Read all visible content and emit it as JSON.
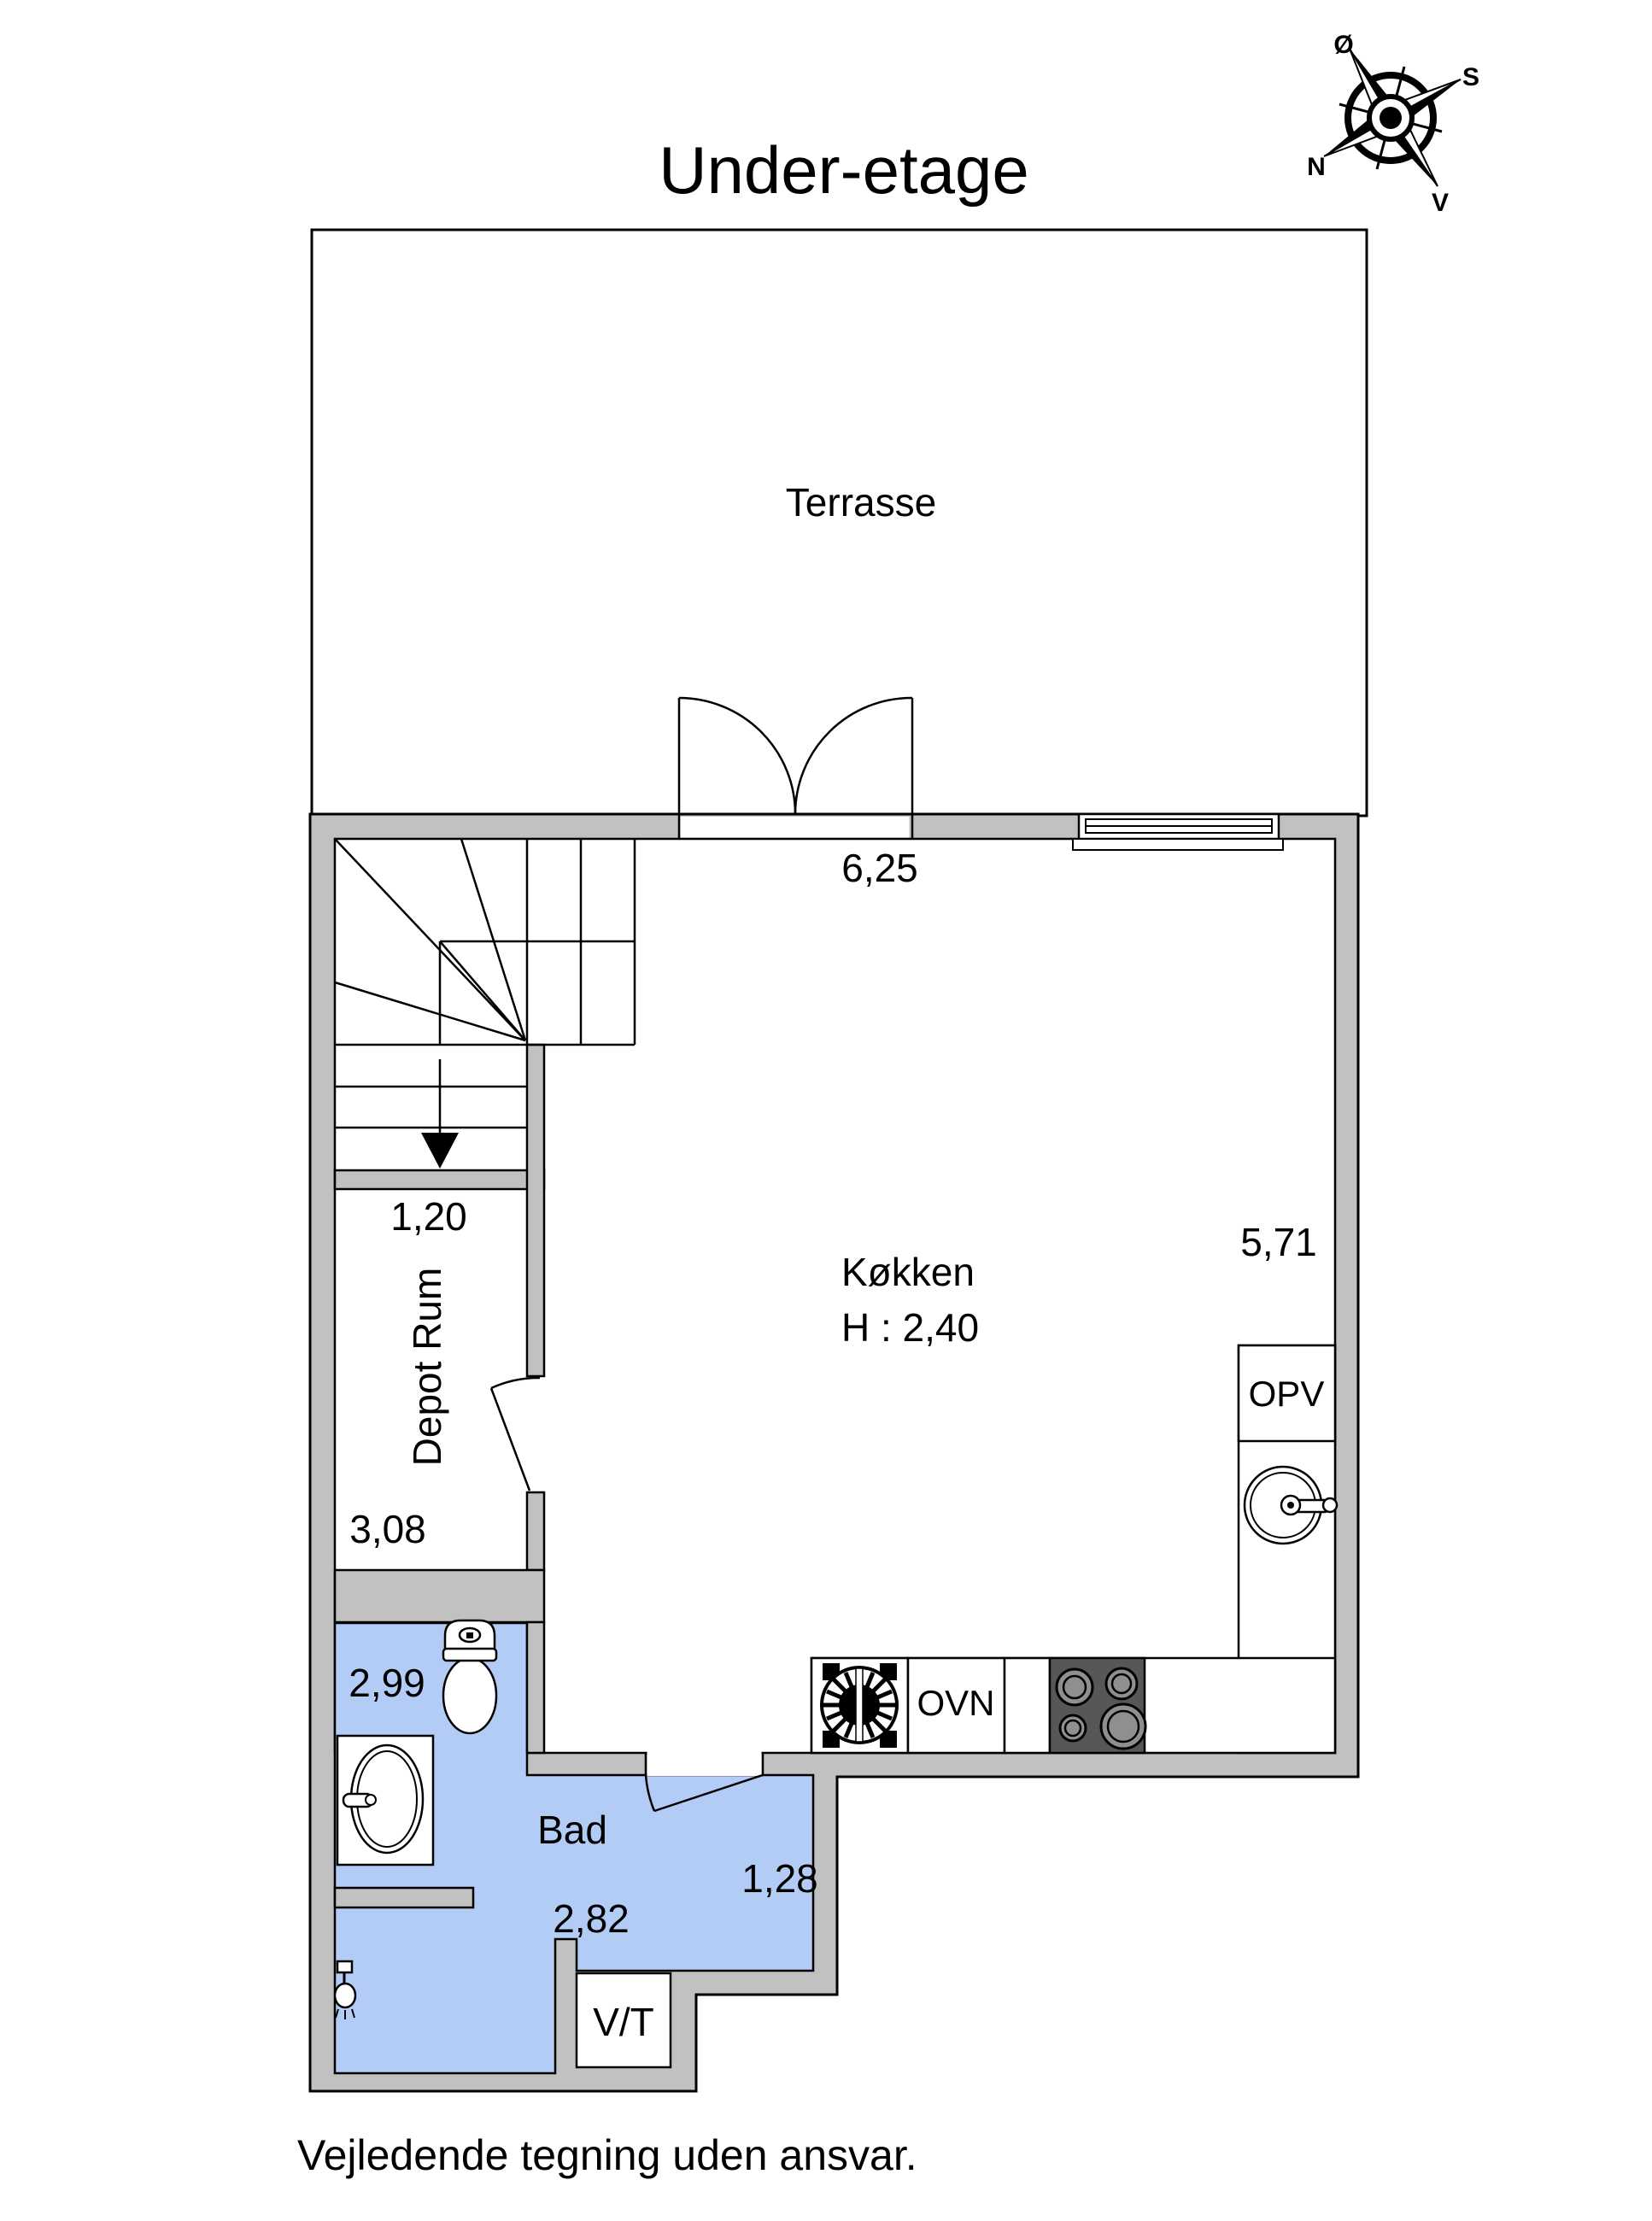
{
  "title": "Under-etage",
  "footer": "Vejledende tegning uden ansvar.",
  "compass": {
    "east_label": "Ø",
    "south_label": "S",
    "north_label": "N",
    "west_label": "V"
  },
  "rooms": {
    "terrasse_label": "Terrasse",
    "kitchen_label": "Køkken",
    "kitchen_ceiling_height": "H : 2,40",
    "kitchen_width": "6,25",
    "kitchen_depth": "5,71",
    "depot_label": "Depot Rum",
    "depot_width": "1,20",
    "depot_depth": "3,08",
    "bath_label": "Bad",
    "bath_top_width": "2,99",
    "bath_width": "2,82",
    "bath_right_depth": "1,28",
    "utility_label": "V/T"
  },
  "appliances": {
    "dishwasher_label": "OPV",
    "oven_label": "OVN"
  },
  "colors": {
    "wall_fill": "#c1c1c1",
    "bath_fill": "#b3ccf5",
    "stove_fill": "#575757",
    "burner_fill": "#8f8f8f",
    "line": "#000000",
    "floor_fill": "#ffffff"
  }
}
